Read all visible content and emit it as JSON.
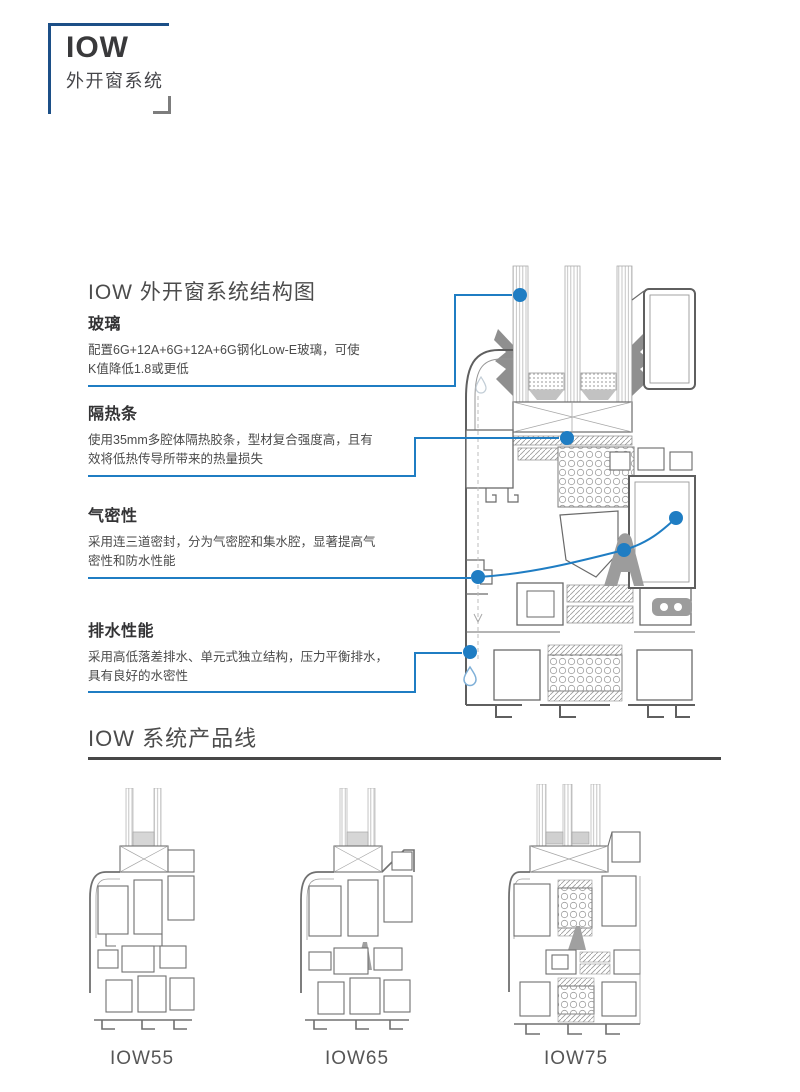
{
  "logo": {
    "title": "IOW",
    "subtitle": "外开窗系统"
  },
  "structure_section": {
    "heading": "IOW 外开窗系统结构图",
    "features": [
      {
        "title": "玻璃",
        "body": "配置6G+12A+6G+12A+6G钢化Low-E玻璃，可使\nK值降低1.8或更低"
      },
      {
        "title": "隔热条",
        "body": "使用35mm多腔体隔热胶条，型材复合强度高，且有\n效将低热传导所带来的热量损失"
      },
      {
        "title": "气密性",
        "body": "采用连三道密封，分为气密腔和集水腔，显著提高气\n密性和防水性能"
      },
      {
        "title": "排水性能",
        "body": "采用高低落差排水、单元式独立结构，压力平衡排水，\n具有良好的水密性"
      }
    ]
  },
  "product_section": {
    "heading": "IOW 系统产品线",
    "products": [
      {
        "label": "IOW55"
      },
      {
        "label": "IOW65"
      },
      {
        "label": "IOW75"
      }
    ]
  },
  "colors": {
    "accent_blue": "#1f7dc3",
    "navy_bracket": "#1c4f87",
    "gray_bracket": "#7d7d7d",
    "heading_text": "#4c4c4c",
    "body_text": "#4a4a4a",
    "rule_dark": "#474747",
    "diagram_line": "#6a6a6a",
    "hardware_gray": "#9c9c9c"
  }
}
